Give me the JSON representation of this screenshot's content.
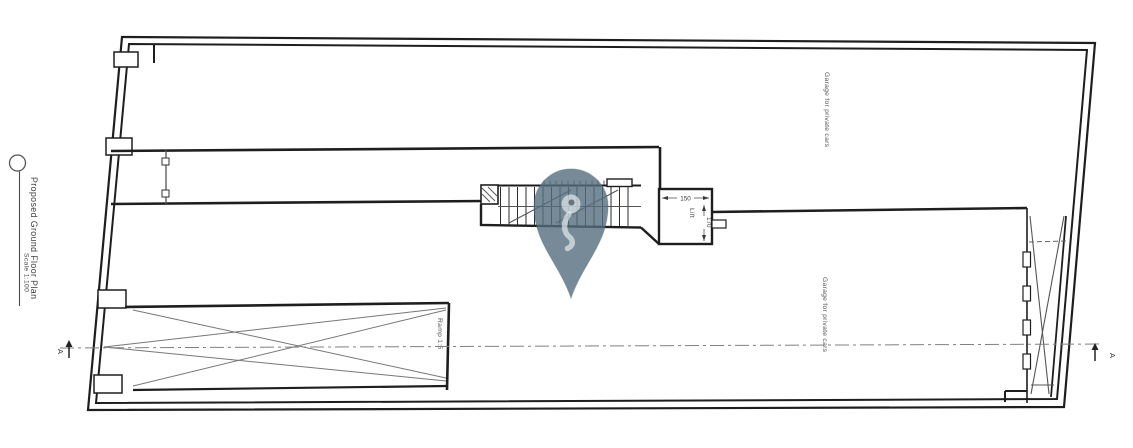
{
  "app": {
    "background": "#ffffff"
  },
  "title_block": {
    "title": "Proposed Ground Floor Plan",
    "scale": "Scale 1:100"
  },
  "plan": {
    "rooms": {
      "garage_upper_label": "Garage for private cars",
      "garage_lower_label": "Garage for private cars",
      "lift_label": "Lift",
      "ramp_label": "Ramp 1:5"
    },
    "dimensions": {
      "lift_width": "150",
      "lift_depth": "170"
    },
    "section_markers": {
      "left_label": "A",
      "right_label": "A"
    },
    "colors": {
      "line": "#1e1e1e",
      "thin_line": "#555555",
      "centerline": "#808080",
      "text": "#4a4a4a"
    }
  },
  "overlay": {
    "pin_color": "#546F7E"
  }
}
